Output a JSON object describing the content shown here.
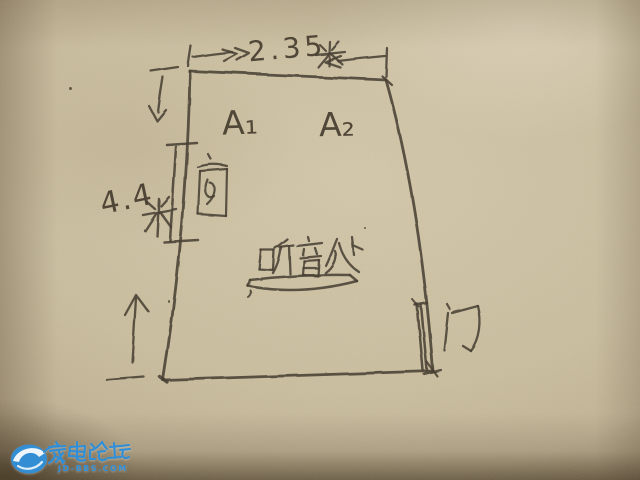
{
  "scene": {
    "description": "hand-drawn room floor plan sketch on kraft paper",
    "paper_color": "#c6b897",
    "ink_color": "#4a4134"
  },
  "diagram": {
    "room": {
      "width_dimension": {
        "value": "2.35",
        "unit": "米",
        "full_label": "2.35米"
      },
      "height_dimension": {
        "value": "4.4",
        "unit": "米",
        "full_label": "4.4米"
      }
    },
    "labels": {
      "speaker_left": "A₁",
      "speaker_right": "A₂",
      "window": "窗",
      "door": "门",
      "listening_area": "听音处"
    }
  },
  "watermark": {
    "site_name": "家电论坛",
    "site_url": "JD-BBS.COM",
    "brand_color": "#2e8ed8"
  }
}
